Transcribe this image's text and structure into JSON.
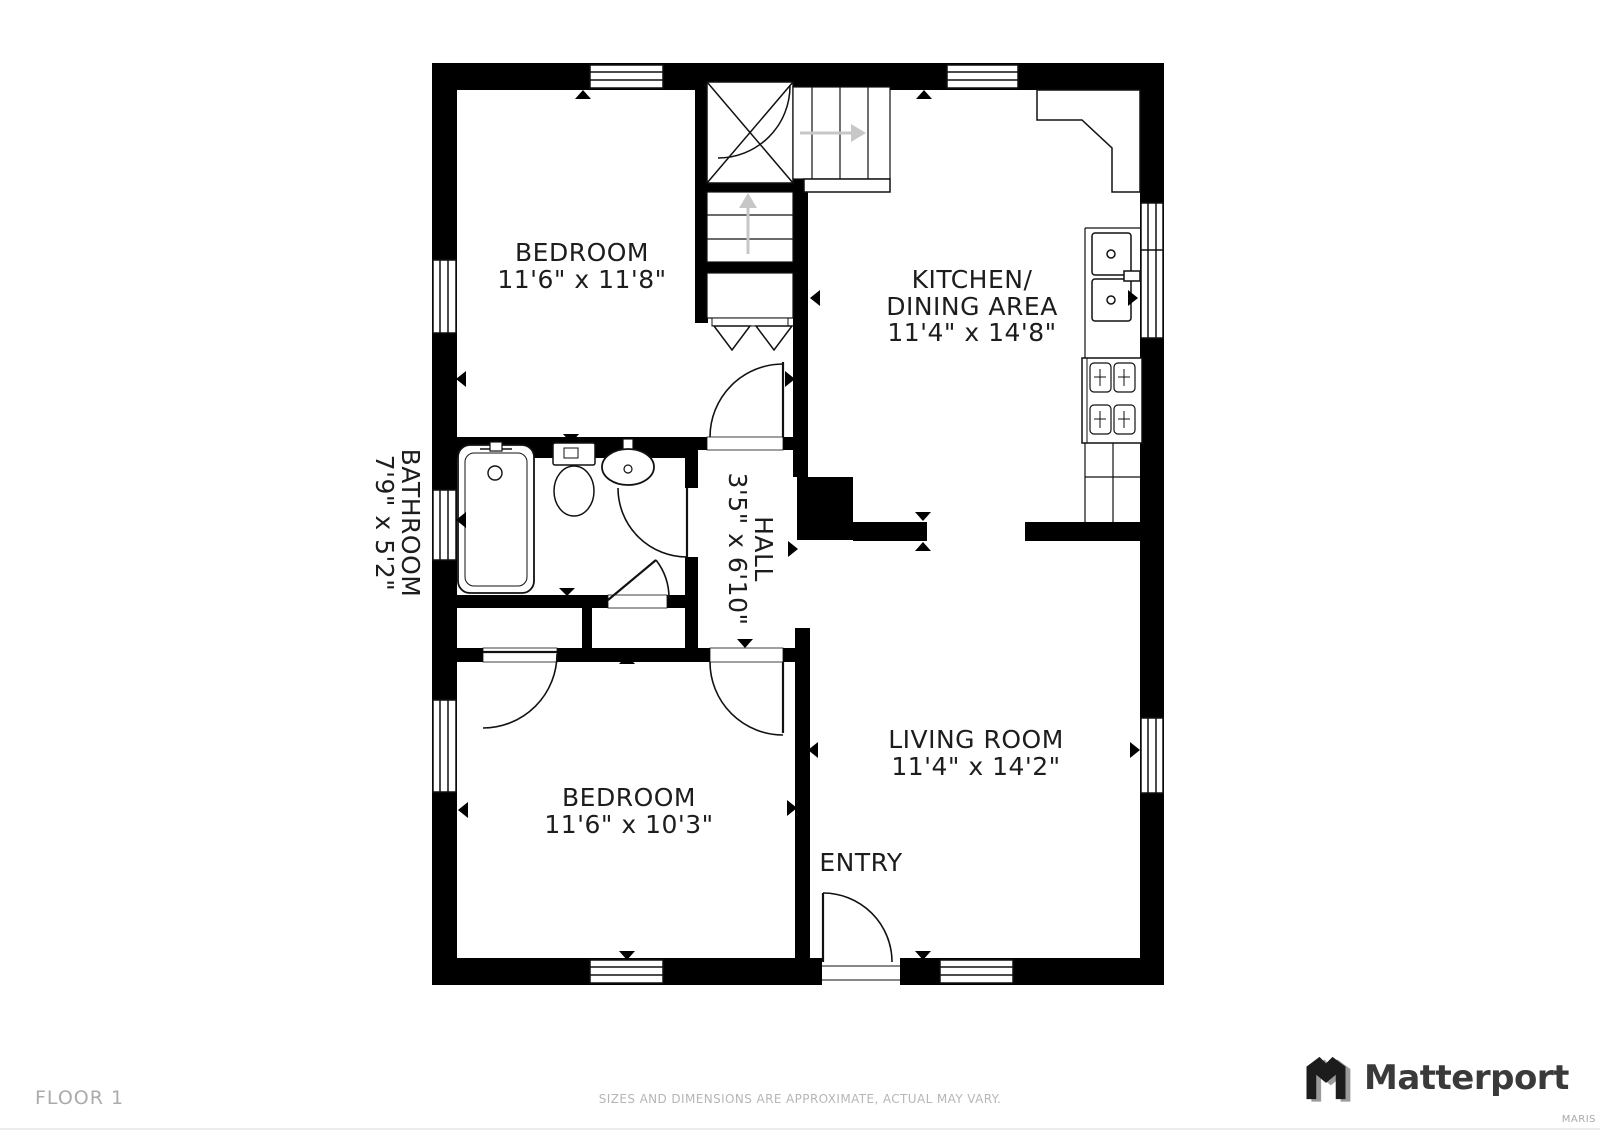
{
  "floorplan": {
    "rooms": {
      "bedroom1": {
        "name": "BEDROOM",
        "dims": "11'6\" x 11'8\""
      },
      "kitchen": {
        "line1": "KITCHEN/",
        "line2": "DINING AREA",
        "dims": "11'4\" x 14'8\""
      },
      "bathroom": {
        "name": "BATHROOM",
        "dims": "7'9\" x 5'2\""
      },
      "hall": {
        "name": "HALL",
        "dims": "3'5\" x 6'10\""
      },
      "bedroom2": {
        "name": "BEDROOM",
        "dims": "11'6\" x 10'3\""
      },
      "living_room": {
        "name": "LIVING ROOM",
        "dims": "11'4\" x 14'2\""
      },
      "entry": {
        "name": "ENTRY"
      }
    },
    "icons": [
      "stairs-up-icon",
      "stairs-down-icon",
      "bathtub-icon",
      "toilet-icon",
      "sink-icon",
      "kitchen-sink-icon",
      "stove-icon",
      "door-swing-icon",
      "window-icon",
      "direction-marker-icon"
    ]
  },
  "footer": {
    "floor_label": "FLOOR 1",
    "disclaimer": "SIZES AND DIMENSIONS ARE APPROXIMATE, ACTUAL MAY VARY.",
    "attribution": "MARIS"
  },
  "brand": {
    "name": "Matterport"
  },
  "colors": {
    "wall": "#000000",
    "line": "#111111",
    "label": "#1d1d1d",
    "stair_arrow": "#c7c7c7",
    "muted_text": "#b0b0b0",
    "brand_text": "#3a3a3a",
    "brand_shade": "#9b9b9b"
  }
}
